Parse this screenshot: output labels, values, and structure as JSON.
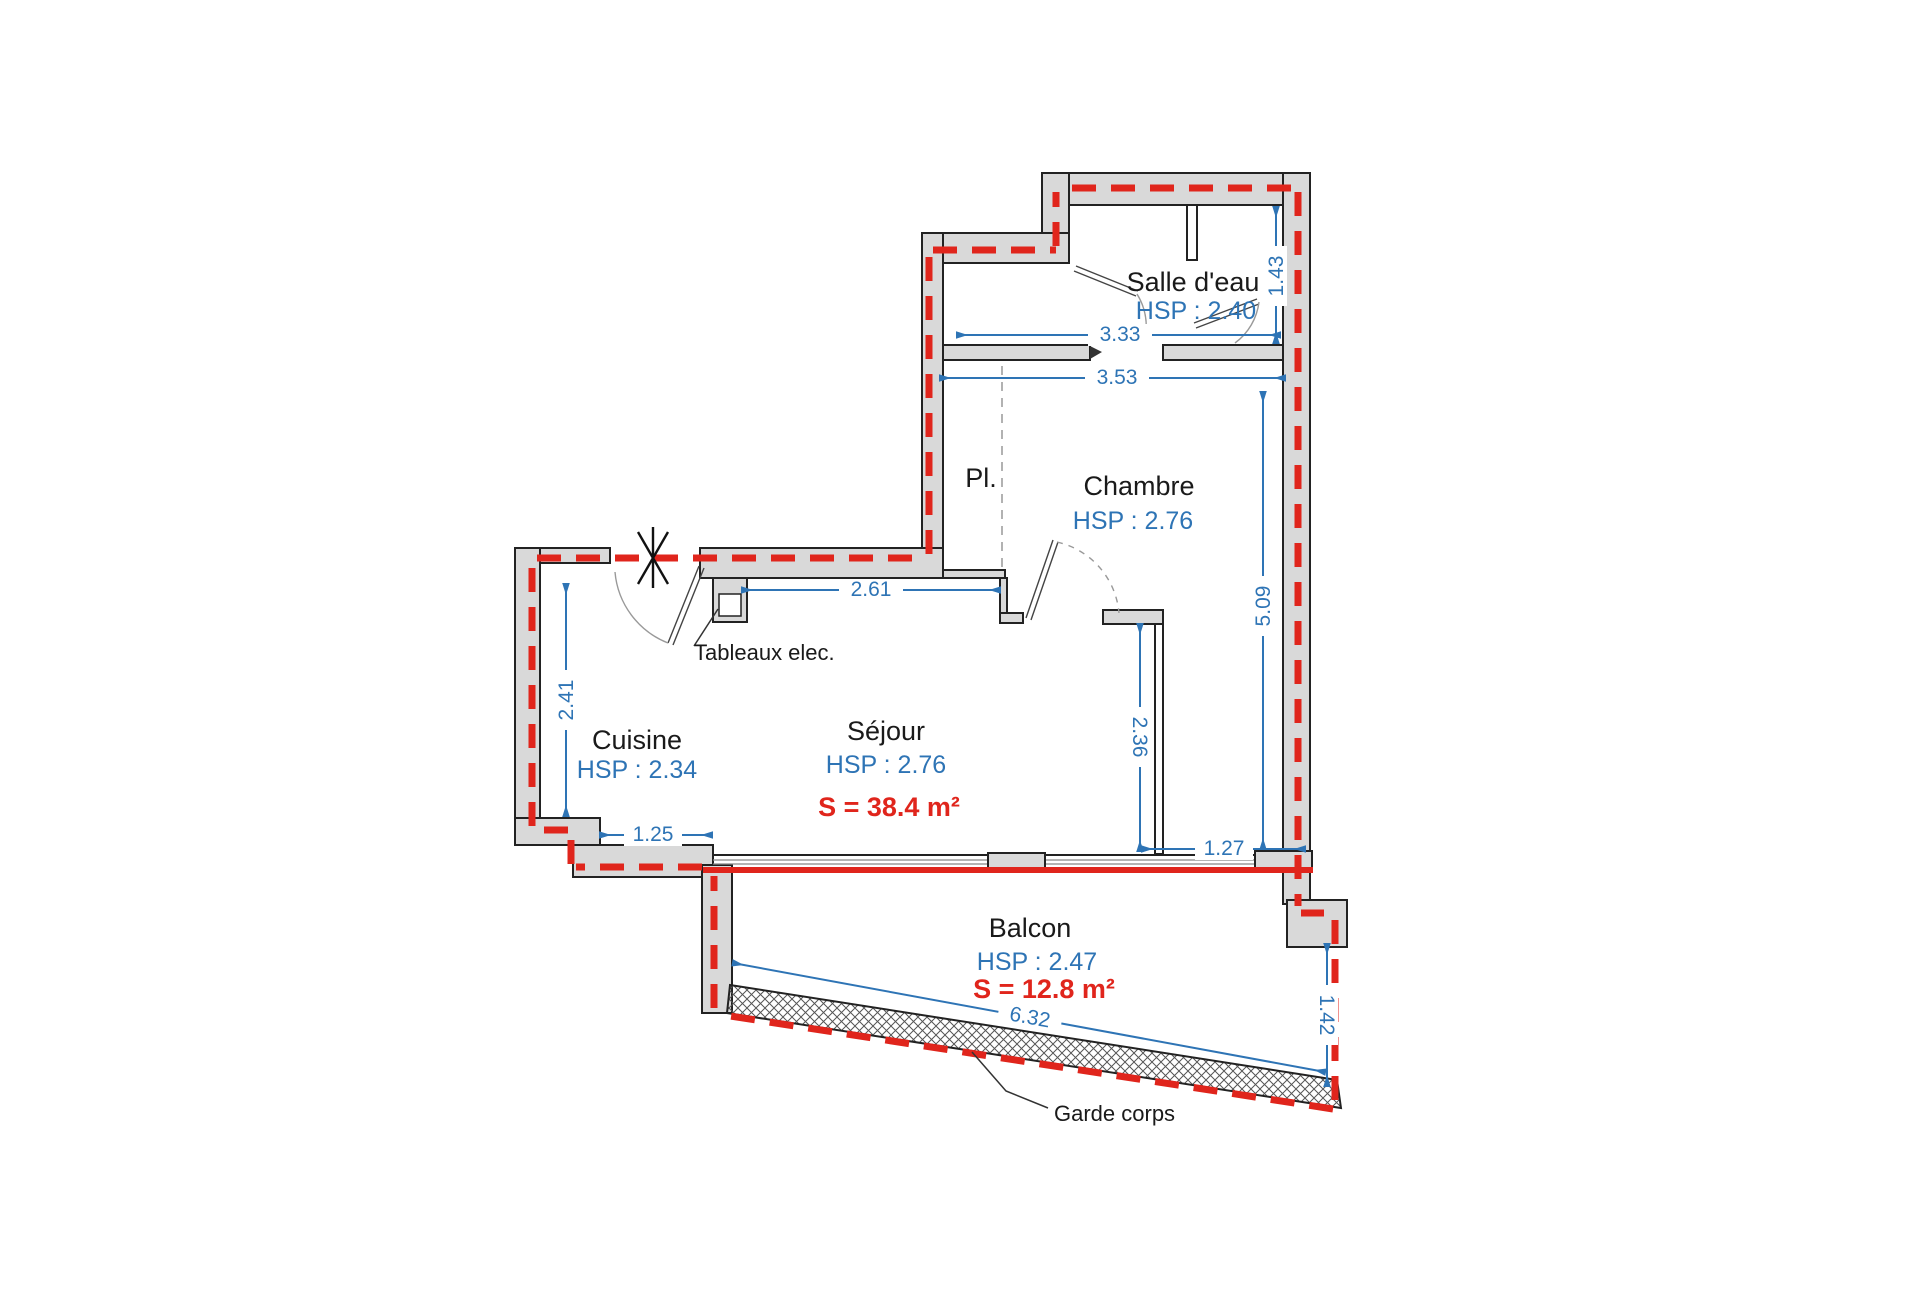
{
  "rooms": {
    "salle_deau": {
      "name": "Salle d'eau",
      "hsp": "HSP : 2.40"
    },
    "chambre": {
      "name": "Chambre",
      "hsp": "HSP : 2.76"
    },
    "placard": {
      "name": "Pl."
    },
    "cuisine": {
      "name": "Cuisine",
      "hsp": "HSP : 2.34"
    },
    "sejour": {
      "name": "Séjour",
      "hsp": "HSP : 2.76",
      "area": "S = 38.4 m²"
    },
    "balcon": {
      "name": "Balcon",
      "hsp": "HSP : 2.47",
      "area": "S = 12.8 m²"
    }
  },
  "dimensions": {
    "salle_deau_width": "3.33",
    "chambre_width": "3.53",
    "wc_depth": "1.43",
    "chambre_height": "5.09",
    "sejour_top_width": "2.61",
    "cuisine_depth": "2.41",
    "partition_length": "2.36",
    "cuisine_return": "1.25",
    "window_right_offset": "1.27",
    "balcon_length": "6.32",
    "balcon_right_depth": "1.42"
  },
  "annotations": {
    "tableaux_elec": "Tableaux elec.",
    "garde_corps": "Garde corps"
  },
  "colors": {
    "dimension_blue": "#2e74b5",
    "boundary_red": "#e0251c",
    "wall_gray": "#d9d9d9"
  }
}
